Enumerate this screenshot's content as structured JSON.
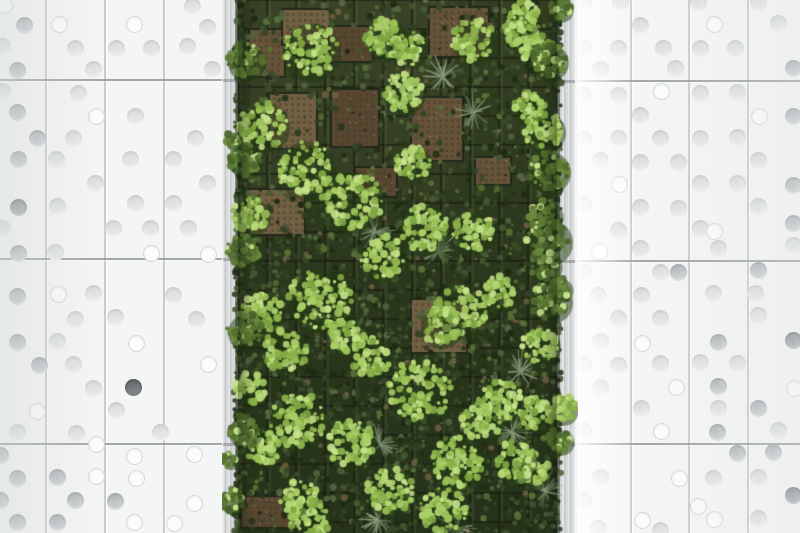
{
  "scene": {
    "label": "lush vertical garden living wall framed by white perforated facade panels",
    "image": {
      "width": 800,
      "height": 533
    }
  },
  "palette": {
    "panel_white": "#f4f5f5",
    "seam_vertical": "#c9cccd",
    "seam_horizontal": "#85898c",
    "dot_gray_1": "#b6babc",
    "dot_gray_2": "#d3d6d7",
    "dot_light_1": "#dcdedf",
    "dot_light_2": "#ebeded",
    "dot_outline_bg": "#fbfcfc",
    "dot_outline_border": "#d6d9da",
    "dot_dark_1": "#94989b",
    "dot_dark_2": "#b2b6b8",
    "dot_darkest_1": "#6f7476",
    "dot_darkest_2": "#8a8e90"
  },
  "left_wall": {
    "x": 0,
    "w": 222,
    "v_seams": [
      45,
      104,
      163
    ],
    "h_seams": [
      79,
      258,
      443
    ],
    "dots": [
      [
        3,
        4,
        "o"
      ],
      [
        24,
        25,
        "g"
      ],
      [
        58,
        23,
        "o"
      ],
      [
        133,
        23,
        "o"
      ],
      [
        192,
        6,
        "l"
      ],
      [
        2,
        46,
        "l"
      ],
      [
        75,
        48,
        "l"
      ],
      [
        116,
        48,
        "l"
      ],
      [
        151,
        48,
        "l"
      ],
      [
        207,
        27,
        "l"
      ],
      [
        17,
        70,
        "g"
      ],
      [
        93,
        69,
        "l"
      ],
      [
        187,
        46,
        "l"
      ],
      [
        212,
        69,
        "l"
      ],
      [
        2,
        91,
        "l"
      ],
      [
        78,
        93,
        "l"
      ],
      [
        17,
        112,
        "g"
      ],
      [
        95,
        115,
        "o"
      ],
      [
        135,
        116,
        "l"
      ],
      [
        37,
        138,
        "g"
      ],
      [
        73,
        138,
        "l"
      ],
      [
        195,
        138,
        "l"
      ],
      [
        18,
        159,
        "g"
      ],
      [
        56,
        159,
        "l"
      ],
      [
        130,
        159,
        "l"
      ],
      [
        173,
        159,
        "l"
      ],
      [
        95,
        183,
        "l"
      ],
      [
        207,
        183,
        "l"
      ],
      [
        18,
        207,
        "d"
      ],
      [
        57,
        206,
        "l"
      ],
      [
        135,
        203,
        "l"
      ],
      [
        173,
        203,
        "l"
      ],
      [
        2,
        228,
        "l"
      ],
      [
        113,
        228,
        "l"
      ],
      [
        150,
        228,
        "l"
      ],
      [
        188,
        228,
        "l"
      ],
      [
        18,
        253,
        "g"
      ],
      [
        55,
        252,
        "l"
      ],
      [
        150,
        252,
        "o"
      ],
      [
        207,
        253,
        "o"
      ],
      [
        17,
        296,
        "g"
      ],
      [
        57,
        293,
        "o"
      ],
      [
        93,
        293,
        "l"
      ],
      [
        173,
        295,
        "l"
      ],
      [
        75,
        319,
        "l"
      ],
      [
        115,
        317,
        "l"
      ],
      [
        196,
        319,
        "l"
      ],
      [
        17,
        342,
        "g"
      ],
      [
        57,
        341,
        "l"
      ],
      [
        135,
        342,
        "o"
      ],
      [
        39,
        365,
        "g"
      ],
      [
        73,
        364,
        "l"
      ],
      [
        207,
        363,
        "o"
      ],
      [
        93,
        388,
        "l"
      ],
      [
        133,
        387,
        "x"
      ],
      [
        36,
        410,
        "o"
      ],
      [
        116,
        410,
        "l"
      ],
      [
        17,
        432,
        "l"
      ],
      [
        76,
        433,
        "l"
      ],
      [
        160,
        432,
        "l"
      ],
      [
        0,
        455,
        "g"
      ],
      [
        95,
        443,
        "o"
      ],
      [
        133,
        455,
        "o"
      ],
      [
        193,
        453,
        "o"
      ],
      [
        17,
        478,
        "g"
      ],
      [
        57,
        477,
        "g"
      ],
      [
        95,
        475,
        "o"
      ],
      [
        135,
        477,
        "o"
      ],
      [
        0,
        500,
        "g"
      ],
      [
        75,
        500,
        "g"
      ],
      [
        115,
        501,
        "g"
      ],
      [
        193,
        502,
        "o"
      ],
      [
        17,
        522,
        "g"
      ],
      [
        57,
        522,
        "g"
      ],
      [
        133,
        521,
        "o"
      ],
      [
        173,
        522,
        "o"
      ]
    ]
  },
  "right_wall": {
    "x": 575,
    "w": 225,
    "v_seams": [
      630,
      688,
      747
    ],
    "h_seams": [
      80,
      260,
      443
    ],
    "dots": [
      [
        583,
        3,
        "l"
      ],
      [
        620,
        2,
        "l"
      ],
      [
        698,
        2,
        "l"
      ],
      [
        758,
        2,
        "l"
      ],
      [
        640,
        25,
        "l"
      ],
      [
        713,
        23,
        "o"
      ],
      [
        778,
        23,
        "l"
      ],
      [
        583,
        48,
        "l"
      ],
      [
        618,
        48,
        "l"
      ],
      [
        663,
        48,
        "l"
      ],
      [
        700,
        48,
        "l"
      ],
      [
        735,
        48,
        "l"
      ],
      [
        600,
        69,
        "l"
      ],
      [
        675,
        68,
        "l"
      ],
      [
        793,
        68,
        "g"
      ],
      [
        583,
        95,
        "l"
      ],
      [
        618,
        95,
        "l"
      ],
      [
        660,
        90,
        "o"
      ],
      [
        700,
        93,
        "l"
      ],
      [
        737,
        92,
        "l"
      ],
      [
        640,
        115,
        "l"
      ],
      [
        758,
        115,
        "o"
      ],
      [
        793,
        116,
        "g"
      ],
      [
        583,
        139,
        "l"
      ],
      [
        618,
        138,
        "l"
      ],
      [
        660,
        138,
        "l"
      ],
      [
        700,
        138,
        "l"
      ],
      [
        737,
        137,
        "l"
      ],
      [
        600,
        160,
        "l"
      ],
      [
        640,
        162,
        "l"
      ],
      [
        678,
        162,
        "l"
      ],
      [
        758,
        160,
        "l"
      ],
      [
        618,
        183,
        "o"
      ],
      [
        700,
        183,
        "l"
      ],
      [
        737,
        183,
        "l"
      ],
      [
        793,
        185,
        "g"
      ],
      [
        583,
        204,
        "l"
      ],
      [
        640,
        207,
        "l"
      ],
      [
        678,
        208,
        "l"
      ],
      [
        758,
        206,
        "l"
      ],
      [
        618,
        230,
        "l"
      ],
      [
        700,
        228,
        "l"
      ],
      [
        713,
        230,
        "o"
      ],
      [
        793,
        223,
        "g"
      ],
      [
        598,
        250,
        "o"
      ],
      [
        640,
        248,
        "l"
      ],
      [
        718,
        248,
        "l"
      ],
      [
        793,
        245,
        "l"
      ],
      [
        583,
        272,
        "l"
      ],
      [
        660,
        272,
        "l"
      ],
      [
        678,
        272,
        "g"
      ],
      [
        758,
        270,
        "g"
      ],
      [
        598,
        295,
        "l"
      ],
      [
        641,
        295,
        "l"
      ],
      [
        713,
        293,
        "l"
      ],
      [
        755,
        293,
        "l"
      ],
      [
        618,
        318,
        "l"
      ],
      [
        660,
        318,
        "l"
      ],
      [
        758,
        315,
        "l"
      ],
      [
        600,
        341,
        "l"
      ],
      [
        641,
        342,
        "o"
      ],
      [
        718,
        342,
        "g"
      ],
      [
        793,
        340,
        "d"
      ],
      [
        583,
        364,
        "l"
      ],
      [
        618,
        365,
        "l"
      ],
      [
        660,
        363,
        "l"
      ],
      [
        700,
        362,
        "l"
      ],
      [
        737,
        363,
        "l"
      ],
      [
        600,
        387,
        "l"
      ],
      [
        675,
        386,
        "o"
      ],
      [
        718,
        386,
        "g"
      ],
      [
        793,
        387,
        "o"
      ],
      [
        641,
        408,
        "l"
      ],
      [
        718,
        408,
        "l"
      ],
      [
        758,
        408,
        "g"
      ],
      [
        583,
        430,
        "l"
      ],
      [
        660,
        430,
        "o"
      ],
      [
        717,
        432,
        "g"
      ],
      [
        778,
        430,
        "l"
      ],
      [
        737,
        453,
        "g"
      ],
      [
        773,
        452,
        "g"
      ],
      [
        600,
        477,
        "l"
      ],
      [
        678,
        477,
        "o"
      ],
      [
        713,
        478,
        "l"
      ],
      [
        758,
        477,
        "l"
      ],
      [
        583,
        500,
        "l"
      ],
      [
        697,
        505,
        "o"
      ],
      [
        793,
        495,
        "d"
      ],
      [
        758,
        518,
        "l"
      ],
      [
        641,
        519,
        "o"
      ],
      [
        713,
        518,
        "o"
      ],
      [
        598,
        528,
        "l"
      ],
      [
        660,
        530,
        "l"
      ]
    ]
  },
  "left_frame": {
    "x": 222,
    "w": 16,
    "joints": [
      79,
      258,
      443
    ]
  },
  "right_frame": {
    "x": 557,
    "w": 18,
    "joints": [
      80,
      260,
      443
    ]
  },
  "green_wall": {
    "geometry": {
      "x": 238,
      "w": 319,
      "h": 533,
      "canvas_x": 222,
      "canvas_w": 356,
      "grid": 29
    },
    "palette": {
      "base_top": "#343f22",
      "base_mid": "#2c381d",
      "base_bottom": "#26321a",
      "grid": "#181d10",
      "grid_hi": "#7d8570",
      "dark": [
        "#1f2a13",
        "#27351a",
        "#2f401f",
        "#394b26",
        "#445831",
        "#33432a",
        "#526440"
      ],
      "bright": [
        "#8ab14a",
        "#9cc258",
        "#a9ce67",
        "#b7d877",
        "#7fa643"
      ],
      "mid": [
        "#5d7a35",
        "#6b8a3e",
        "#54702f",
        "#49632c"
      ],
      "highlight": "#c6e28a",
      "fern": [
        "#7e9070",
        "#93a585",
        "#6d7f60"
      ],
      "tray": [
        "#6b573d",
        "#7a6548",
        "#5d4a33"
      ],
      "tray_rim": "#22281a",
      "cluster_shadow": "#223a12",
      "accent_tan": "#6b5e42",
      "accent_light": "#5a7038"
    },
    "trays": [
      [
        250,
        30,
        34,
        46
      ],
      [
        283,
        10,
        46,
        34
      ],
      [
        330,
        27,
        42,
        34
      ],
      [
        430,
        8,
        58,
        48
      ],
      [
        270,
        94,
        46,
        54
      ],
      [
        332,
        90,
        46,
        56
      ],
      [
        412,
        98,
        50,
        62
      ],
      [
        250,
        190,
        54,
        44
      ],
      [
        356,
        168,
        40,
        28
      ],
      [
        476,
        158,
        34,
        26
      ],
      [
        412,
        300,
        54,
        52
      ],
      [
        242,
        497,
        48,
        30
      ]
    ],
    "ferns": [
      [
        375,
        232
      ],
      [
        438,
        252
      ],
      [
        443,
        77
      ],
      [
        473,
        113
      ],
      [
        520,
        372
      ],
      [
        380,
        445
      ],
      [
        512,
        432
      ],
      [
        545,
        492
      ],
      [
        378,
        520
      ],
      [
        457,
        528
      ]
    ],
    "clusters": [
      [
        310,
        50,
        28,
        0
      ],
      [
        385,
        38,
        20,
        0
      ],
      [
        407,
        48,
        18,
        0
      ],
      [
        473,
        40,
        22,
        0
      ],
      [
        522,
        30,
        18,
        0
      ],
      [
        537,
        50,
        16,
        0
      ],
      [
        524,
        16,
        16,
        0
      ],
      [
        263,
        125,
        24,
        0
      ],
      [
        305,
        168,
        28,
        0
      ],
      [
        352,
        200,
        30,
        0
      ],
      [
        403,
        92,
        20,
        0
      ],
      [
        530,
        107,
        16,
        0
      ],
      [
        543,
        130,
        20,
        0
      ],
      [
        413,
        163,
        18,
        0
      ],
      [
        424,
        228,
        24,
        0
      ],
      [
        473,
        231,
        20,
        0
      ],
      [
        383,
        257,
        22,
        0
      ],
      [
        320,
        300,
        32,
        0
      ],
      [
        262,
        312,
        20,
        0
      ],
      [
        460,
        310,
        26,
        0
      ],
      [
        498,
        292,
        17,
        0
      ],
      [
        285,
        350,
        22,
        0
      ],
      [
        347,
        336,
        18,
        0
      ],
      [
        440,
        325,
        20,
        0
      ],
      [
        540,
        345,
        18,
        0
      ],
      [
        371,
        357,
        20,
        0
      ],
      [
        250,
        388,
        16,
        0
      ],
      [
        420,
        390,
        32,
        0
      ],
      [
        298,
        420,
        28,
        0
      ],
      [
        262,
        448,
        18,
        0
      ],
      [
        350,
        443,
        24,
        0
      ],
      [
        500,
        400,
        22,
        0
      ],
      [
        482,
        420,
        20,
        0
      ],
      [
        537,
        413,
        17,
        0
      ],
      [
        458,
        462,
        26,
        0
      ],
      [
        532,
        470,
        17,
        0
      ],
      [
        390,
        490,
        24,
        0
      ],
      [
        300,
        500,
        20,
        0
      ],
      [
        443,
        510,
        24,
        0
      ],
      [
        310,
        520,
        20,
        0
      ],
      [
        515,
        460,
        20,
        0
      ],
      [
        250,
        215,
        18,
        0
      ],
      [
        545,
        215,
        16,
        1
      ],
      [
        545,
        265,
        15,
        1
      ],
      [
        548,
        170,
        20,
        1
      ],
      [
        548,
        240,
        22,
        1
      ],
      [
        550,
        300,
        20,
        1
      ],
      [
        548,
        60,
        18,
        1
      ],
      [
        245,
        60,
        18,
        1
      ],
      [
        245,
        160,
        16,
        1
      ],
      [
        243,
        250,
        16,
        1
      ],
      [
        245,
        330,
        18,
        1
      ],
      [
        244,
        430,
        16,
        1
      ],
      [
        560,
        8,
        11,
        1
      ],
      [
        560,
        288,
        11,
        1
      ],
      [
        562,
        408,
        14,
        0
      ],
      [
        560,
        440,
        12,
        1
      ],
      [
        232,
        500,
        12,
        1
      ],
      [
        229,
        460,
        7,
        1
      ],
      [
        233,
        140,
        8,
        1
      ]
    ]
  }
}
